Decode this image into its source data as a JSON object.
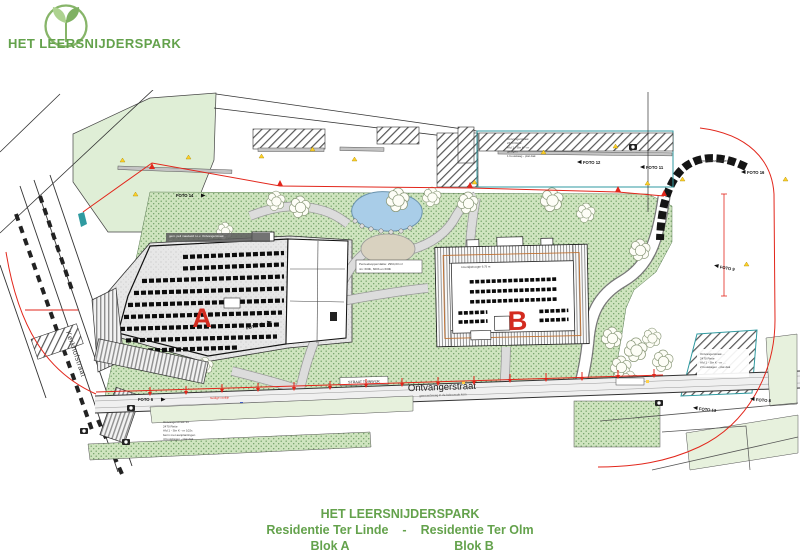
{
  "colors": {
    "brand_green": "#64a24c",
    "label_red": "#d32b1f",
    "boundary_red": "#e2261b",
    "park_bg": "#cfe4bf",
    "park_dot": "#6f9e64",
    "field_green": "#dfeed6",
    "pale_green": "#e7f1dd",
    "pond_blue": "#a9cde8",
    "teal": "#2f9aa0",
    "road_fill": "#f0f0f0"
  },
  "header": {
    "brand": "HET LEERSNIJDERSPARK"
  },
  "plan": {
    "block_a_label": "A",
    "block_b_label": "B",
    "streets": {
      "ontvangerstraat": "Ontvangerstraat",
      "ontvangerstraat_sub": "gemeenteweg in de bebouwde kom",
      "kerkhofstraat": "Kerkhofstraat"
    },
    "labels": {
      "openbaar_domein": "openbaar domein",
      "rooilijn": "huidige rooilijn",
      "road_box": "STRAAT TUINWIJK"
    },
    "foto_labels": [
      "FOTO 14",
      "FOTO 6",
      "FOTO 15",
      "FOTO 12",
      "FOTO 11",
      "FOTO 16",
      "FOTO 9",
      "FOTO 13",
      "FOTO 8"
    ],
    "annotations": {
      "topright": [
        "Ontvangerstraat",
        "2470 Retie",
        "Afd 1 - Sie K - nr …",
        "gelegen",
        "1 bouwlaag - plat dak"
      ],
      "bottomleft": [
        "Ontvangerstraat 34",
        "2470 Retie",
        "Afd 1 - Sie K - nr 102x",
        "berm met aanplantingen",
        "4 bouwlagen - plat dak"
      ],
      "bottomright": [
        "Ontvangerstraat …",
        "2470 Retie",
        "Afd 1 - Sie K - nr …",
        "2 bouwlagen - plat dak"
      ],
      "center": [
        "Perceelsoppervlakte: 2964,03 m²",
        "niv: 600b, 600b en 600b"
      ],
      "blocka": [
        "gem. peil maaiveld t.o.v. Ontvangerstraat",
        "…"
      ],
      "blockb": "kroonlijsthoogte 9,75 m"
    }
  },
  "footer": {
    "title": "HET LEERSNIJDERSPARK",
    "project_left": "Residentie Ter Linde",
    "separator": "-",
    "project_right": "Residentie Ter Olm",
    "block_left": "Blok A",
    "block_right": "Blok B"
  }
}
